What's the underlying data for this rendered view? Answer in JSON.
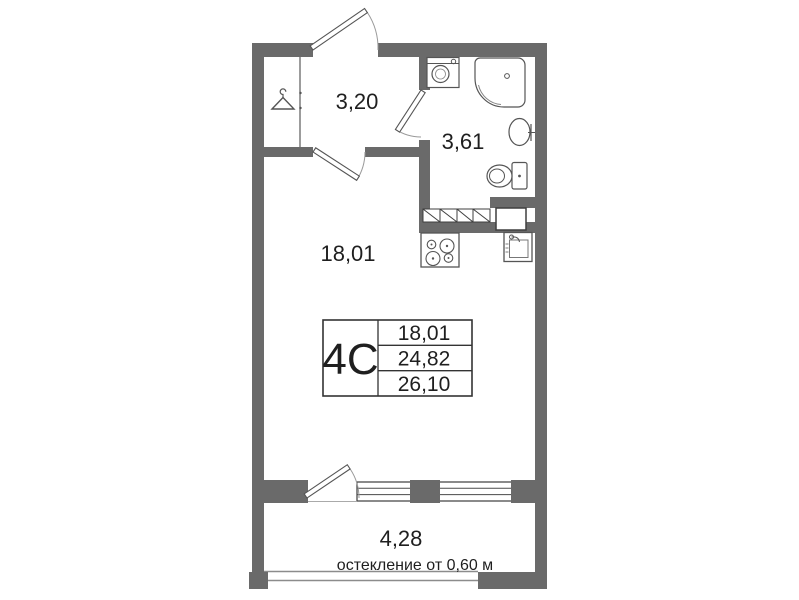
{
  "plan": {
    "unit": {
      "type_label": "4C",
      "area_living": "18,01",
      "area_total": "24,82",
      "area_total_with_balcony": "26,10"
    },
    "rooms": {
      "hallway_area": "3,20",
      "bathroom_area": "3,61",
      "living_area": "18,01",
      "balcony_area": "4,28"
    },
    "balcony_note": "остекление от 0,60 м",
    "colors": {
      "wall": "#6a6a6a",
      "fixture_line": "#555555",
      "text": "#1f1f1f"
    }
  }
}
